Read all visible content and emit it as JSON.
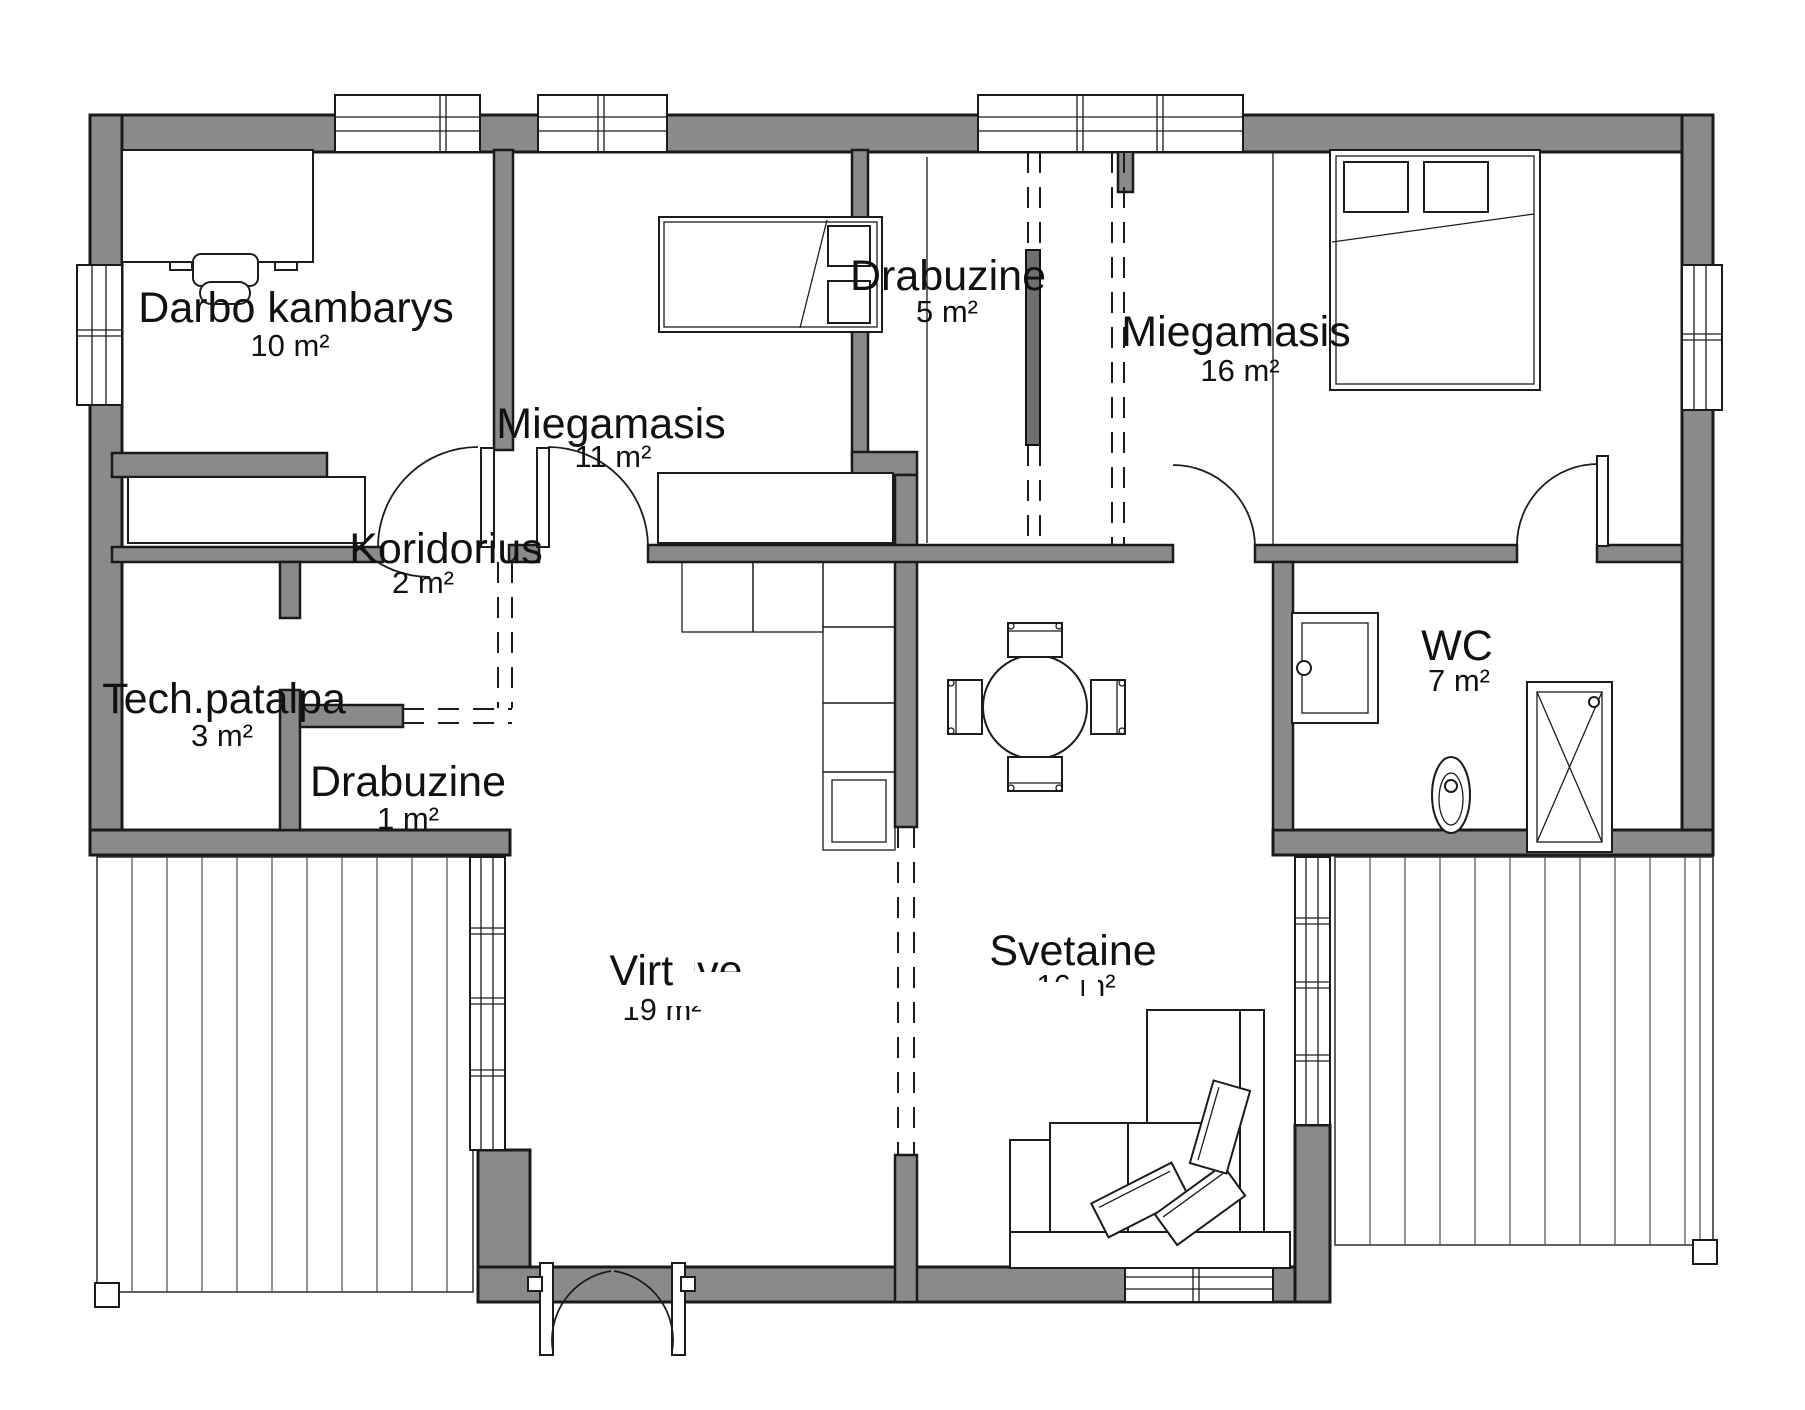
{
  "title": "Namo planas",
  "colors": {
    "wall_fill": "#8a8a8a",
    "outline": "#1a1a1a",
    "background": "#ffffff",
    "sliding_door": "#6f6f6f"
  },
  "rooms": [
    {
      "id": "darbo-kambarys",
      "name": "Darbo kambarys",
      "area": "10 m²"
    },
    {
      "id": "miegamasis-11",
      "name": "Miegamasis",
      "area": "11 m²"
    },
    {
      "id": "drabuzine-5",
      "name": "Drabuzine",
      "area": "5 m²"
    },
    {
      "id": "miegamasis-16",
      "name": "Miegamasis",
      "area": "16 m²"
    },
    {
      "id": "koridorius",
      "name": "Koridorius",
      "area": "2 m²"
    },
    {
      "id": "tech-patalpa",
      "name": "Tech.patalpa",
      "area": "3 m²"
    },
    {
      "id": "drabuzine-1",
      "name": "Drabuzine",
      "area": "1 m²"
    },
    {
      "id": "wc",
      "name": "WC",
      "area": "7 m²"
    },
    {
      "id": "virtuve",
      "name": "Virtuve",
      "area": "19 m²"
    },
    {
      "id": "svetaine",
      "name": "Svetaine",
      "area": "16 m²"
    }
  ]
}
